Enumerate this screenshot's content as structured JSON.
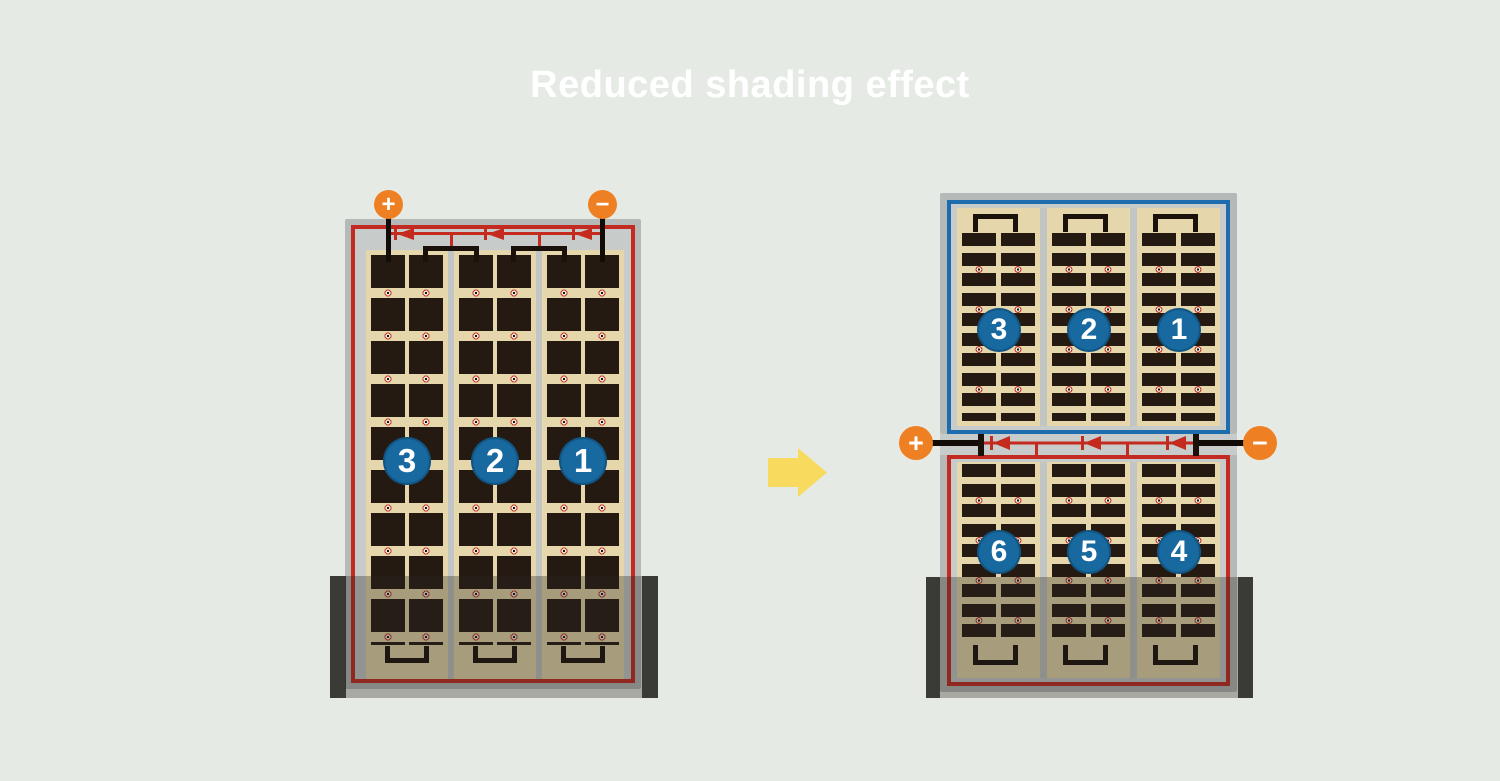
{
  "title": "Reduced shading effect",
  "colors": {
    "background": "#e5ebe4",
    "title_text": "#ffffff",
    "panel_frame": "#b5b9b8",
    "junction_strip": "#c7cbca",
    "cell_background": "#e5d7ab",
    "cell_dark": "#241a12",
    "series_red": "#c52a1e",
    "series_blue": "#1d6cae",
    "badge_blue": "#17699f",
    "terminal_orange": "#ee7f22",
    "arrow_yellow": "#f8db5e",
    "shade_overlay": "rgba(40,35,29,0.33)"
  },
  "left_module": {
    "positive_terminal": "+",
    "negative_terminal": "−",
    "string_labels": [
      "3",
      "2",
      "1"
    ],
    "bypass_diodes": 3,
    "shaded": true
  },
  "right_module": {
    "positive_terminal": "+",
    "negative_terminal": "−",
    "top_half_string_labels": [
      "3",
      "2",
      "1"
    ],
    "bottom_half_string_labels": [
      "6",
      "5",
      "4"
    ],
    "bypass_diodes": 3,
    "shaded": true
  }
}
